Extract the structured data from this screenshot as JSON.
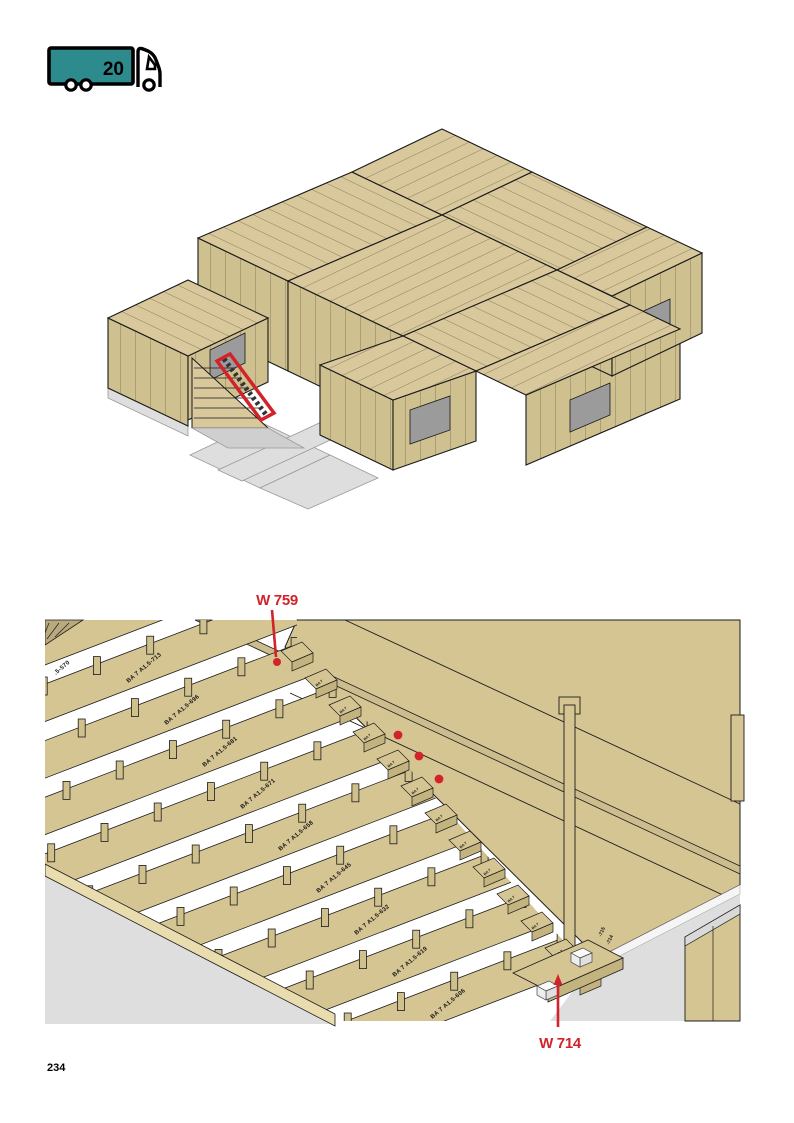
{
  "page": {
    "number": "234"
  },
  "truck_badge": {
    "number": "20",
    "trailer_color": "#2e8b8d",
    "outline_color": "#000000"
  },
  "overview_figure": {
    "wood_color": "#d8c89c",
    "wall_color": "#cfc08f",
    "highlight_color": "#d2232a",
    "ground_color": "#dedede"
  },
  "detail_figure": {
    "wood_color": "#d5c593",
    "line_color": "#1c1c1c",
    "marker_color": "#d2232a",
    "floor_color": "#dcdcdc",
    "red_dot_count": 3,
    "callouts": [
      {
        "label": "W 759",
        "position": "top"
      },
      {
        "label": "W 714",
        "position": "bottom"
      }
    ],
    "panel_labels": [
      ".5-570",
      "BA 7 A1.5-713",
      "BA 7 A1.5-696",
      "BA 7 A1.5-681",
      "BA 7 A1.5-671",
      "BA 7 A1.5-658",
      "BA 7 A1.5-645",
      "BA 7 A1.5-632",
      "BA 7 A1.5-619",
      "BA 7 A1.5-606"
    ],
    "post_labels": [
      "-715",
      "-714"
    ],
    "step_label": "BA 7"
  }
}
